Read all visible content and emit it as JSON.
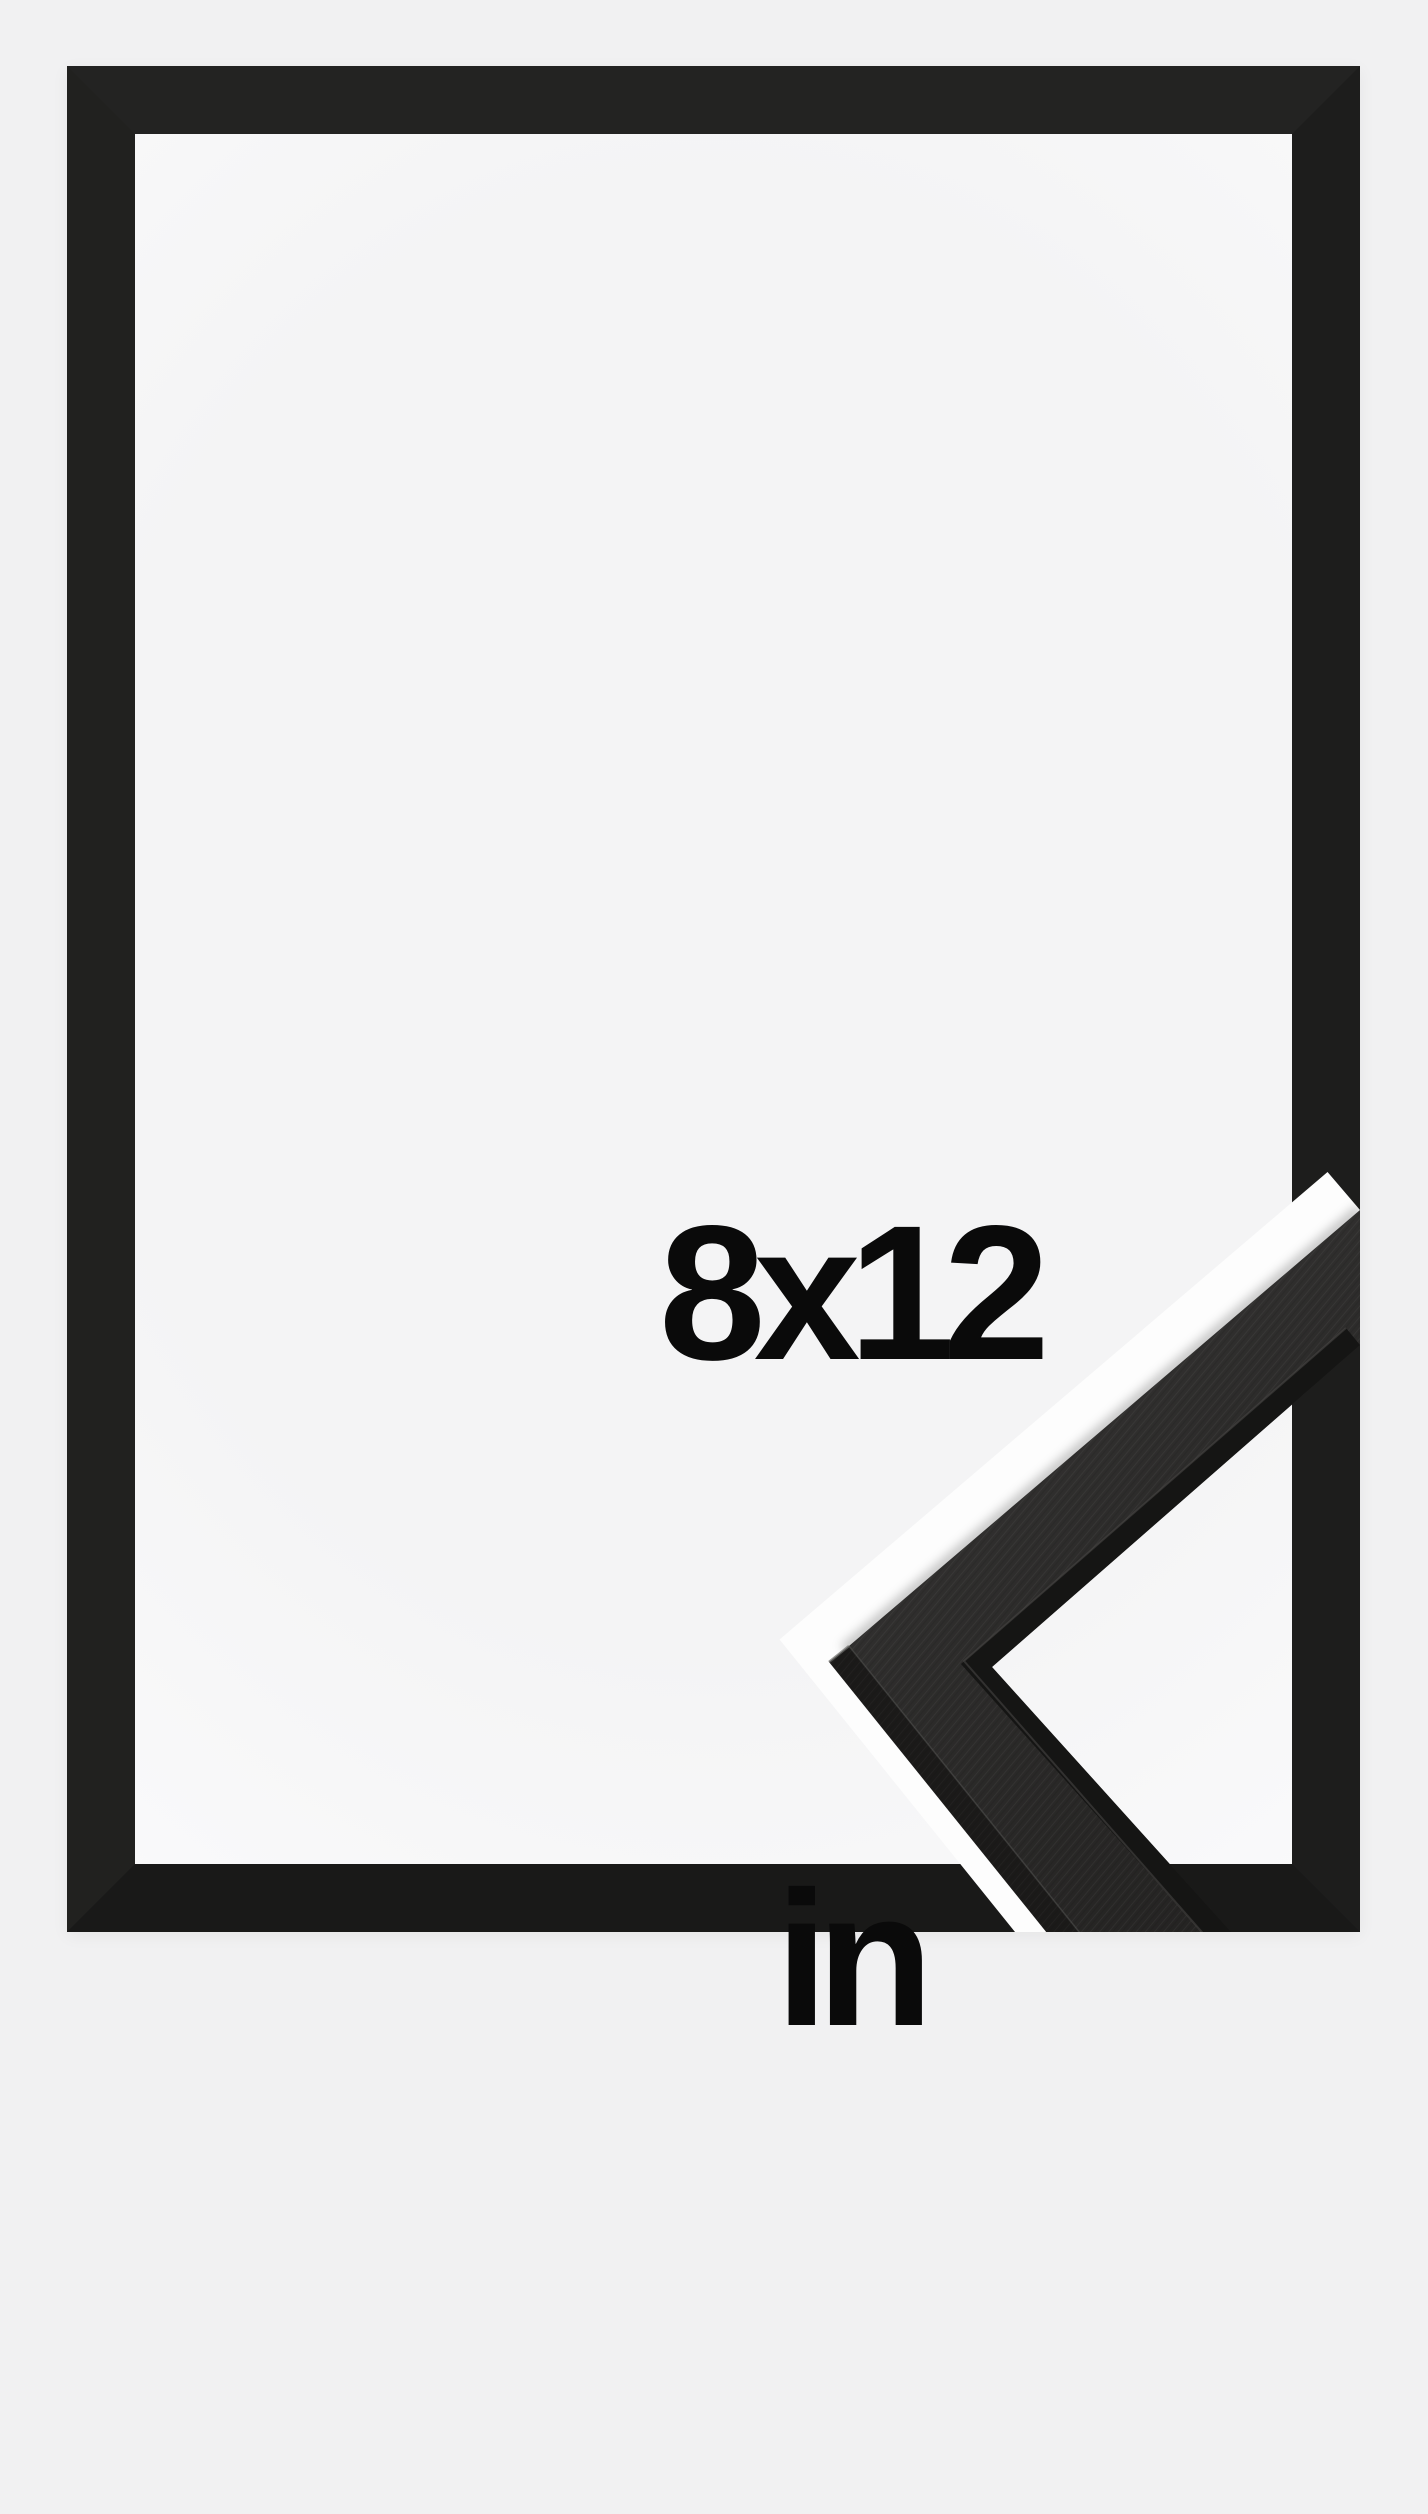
{
  "product_image": {
    "size_label": {
      "dimensions": "8x12",
      "unit": "in"
    },
    "views": {
      "main_view": "black picture frame, front view",
      "detail_view": "close-up of frame corner moulding profile"
    },
    "frame_color_name": "Black"
  },
  "colors": {
    "bg": "#f1f1f2",
    "interior": "#f4f4f5",
    "interior-edge": "#fafafb",
    "frame-top": "#232322",
    "frame-right": "#1d1d1c",
    "frame-bottom": "#191918",
    "frame-left": "#21211f",
    "text": "#0a0a0a",
    "band": "#fdfdfd",
    "moulding-face-light": "#3a3938",
    "moulding-face-dark": "#242322",
    "moulding-side": "#1b1a19",
    "moulding-rabbet": "#151514",
    "moulding-highlight": "#4a4947"
  }
}
